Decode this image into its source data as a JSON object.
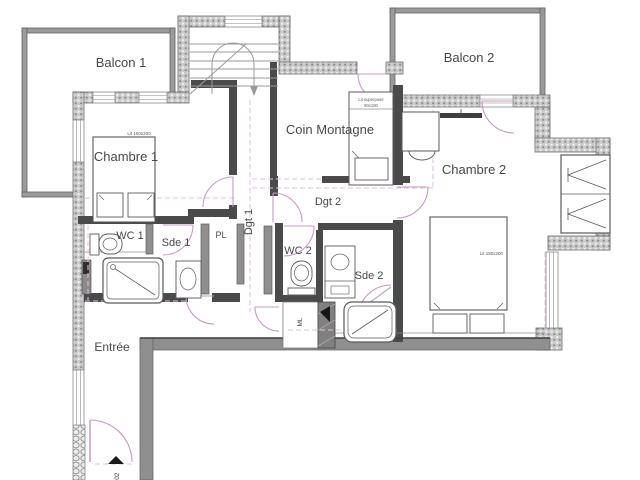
{
  "plan": {
    "title": "Appartement 302 - plan d'etage",
    "rooms": {
      "balcon1": "Balcon 1",
      "balcon2": "Balcon 2",
      "chambre1": "Chambre 1",
      "chambre2": "Chambre 2",
      "coin_montagne": "Coin Montagne",
      "wc1": "WC 1",
      "wc2": "WC 2",
      "sde1": "Sde 1",
      "sde2": "Sde 2",
      "pl": "PL",
      "dgt1": "Dgt 1",
      "dgt2": "Dgt 2",
      "entree": "Entrée",
      "ml": "ML"
    },
    "furniture_labels": {
      "bed1": "Lit 160x200",
      "bed2": "Lit 180x200",
      "bunk_line1": "Lit superposé",
      "bunk_line2": "90x190"
    },
    "door_number": "302",
    "colors": {
      "background": "#ffffff",
      "exterior_wall_hatch": "#cacaca",
      "interior_wall_gray": "#8f8f8f",
      "partition_dark": "#4a4a4a",
      "balcony_wall": "#9a9a9a",
      "door_pink": "#c49ac4",
      "axis_dashed_pink": "#e2bfe2",
      "label_text": "#484848"
    }
  }
}
